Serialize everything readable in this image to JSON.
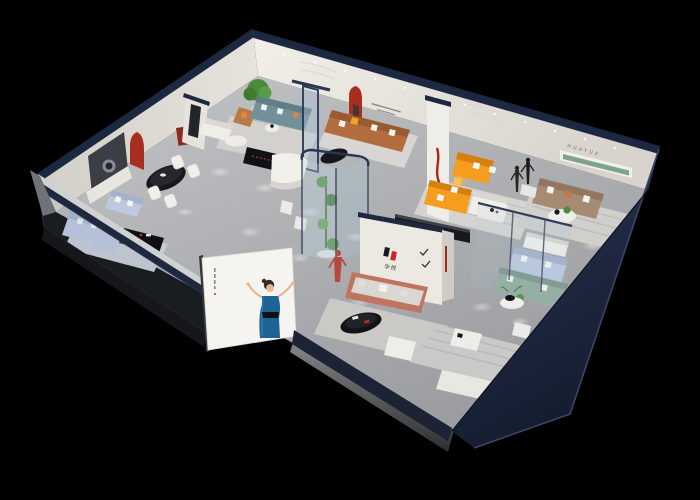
{
  "brand": {
    "wall_lettering": "HUAYUE",
    "logo_text": "华悦"
  },
  "palette": {
    "background": "#000000",
    "floor": "#b3b5b7",
    "wall-white": "#ece9e3",
    "wall-shadow": "#dcd8d1",
    "navy-trim": "#1e2940",
    "exterior-navy": "#232e48",
    "billboard-white": "#f5f4f1",
    "dress-blue": "#1d6394",
    "accent-red": "#a92e22",
    "sofa-orange": "#f59d1e",
    "sofa-caramel": "#b26c3d",
    "sofa-light-blue": "#bdc9df",
    "sofa-teal": "#72909a",
    "sofa-sage": "#93ac9e",
    "sofa-terracotta": "#c0735f",
    "sofa-taupe": "#a78a72",
    "shelf-green": "#7fa28e",
    "plant-green": "#4c8a3c",
    "console-black": "#101114"
  }
}
